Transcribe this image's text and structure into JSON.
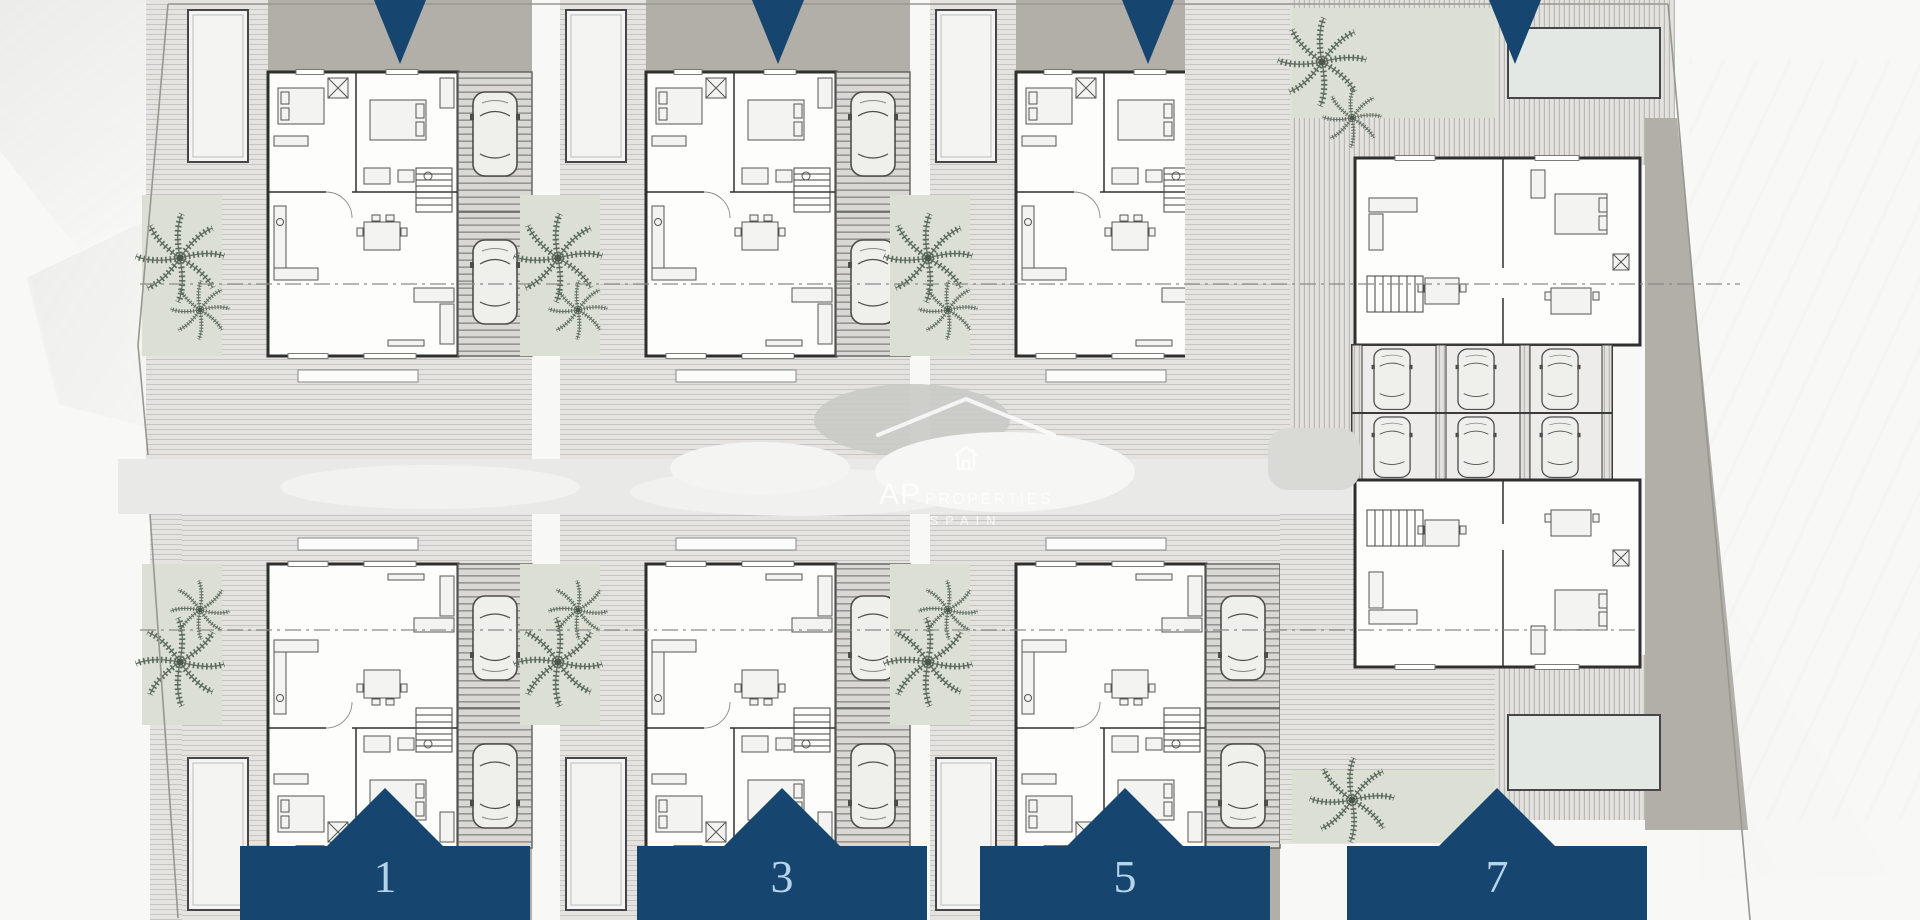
{
  "watermark": {
    "brand": "AP",
    "brand_suffix": "PROPERTIES",
    "region": "SPAIN"
  },
  "markers": {
    "bottom": [
      {
        "label": "1"
      },
      {
        "label": "3"
      },
      {
        "label": "5"
      },
      {
        "label": "7"
      }
    ],
    "top_arrow_count": 4
  },
  "palette": {
    "navy": "#164570",
    "number_blue": "#b5d4ea",
    "taupe_drive": "#b2afa8",
    "sage_green": "#dce0d4",
    "palm_green": "#5e6c5f",
    "road_gray": "#e9e9e7",
    "deck_light": "#e4e3e0",
    "deck_shadow": "#c6c5c1",
    "drawing_line": "#2f2f2d"
  }
}
